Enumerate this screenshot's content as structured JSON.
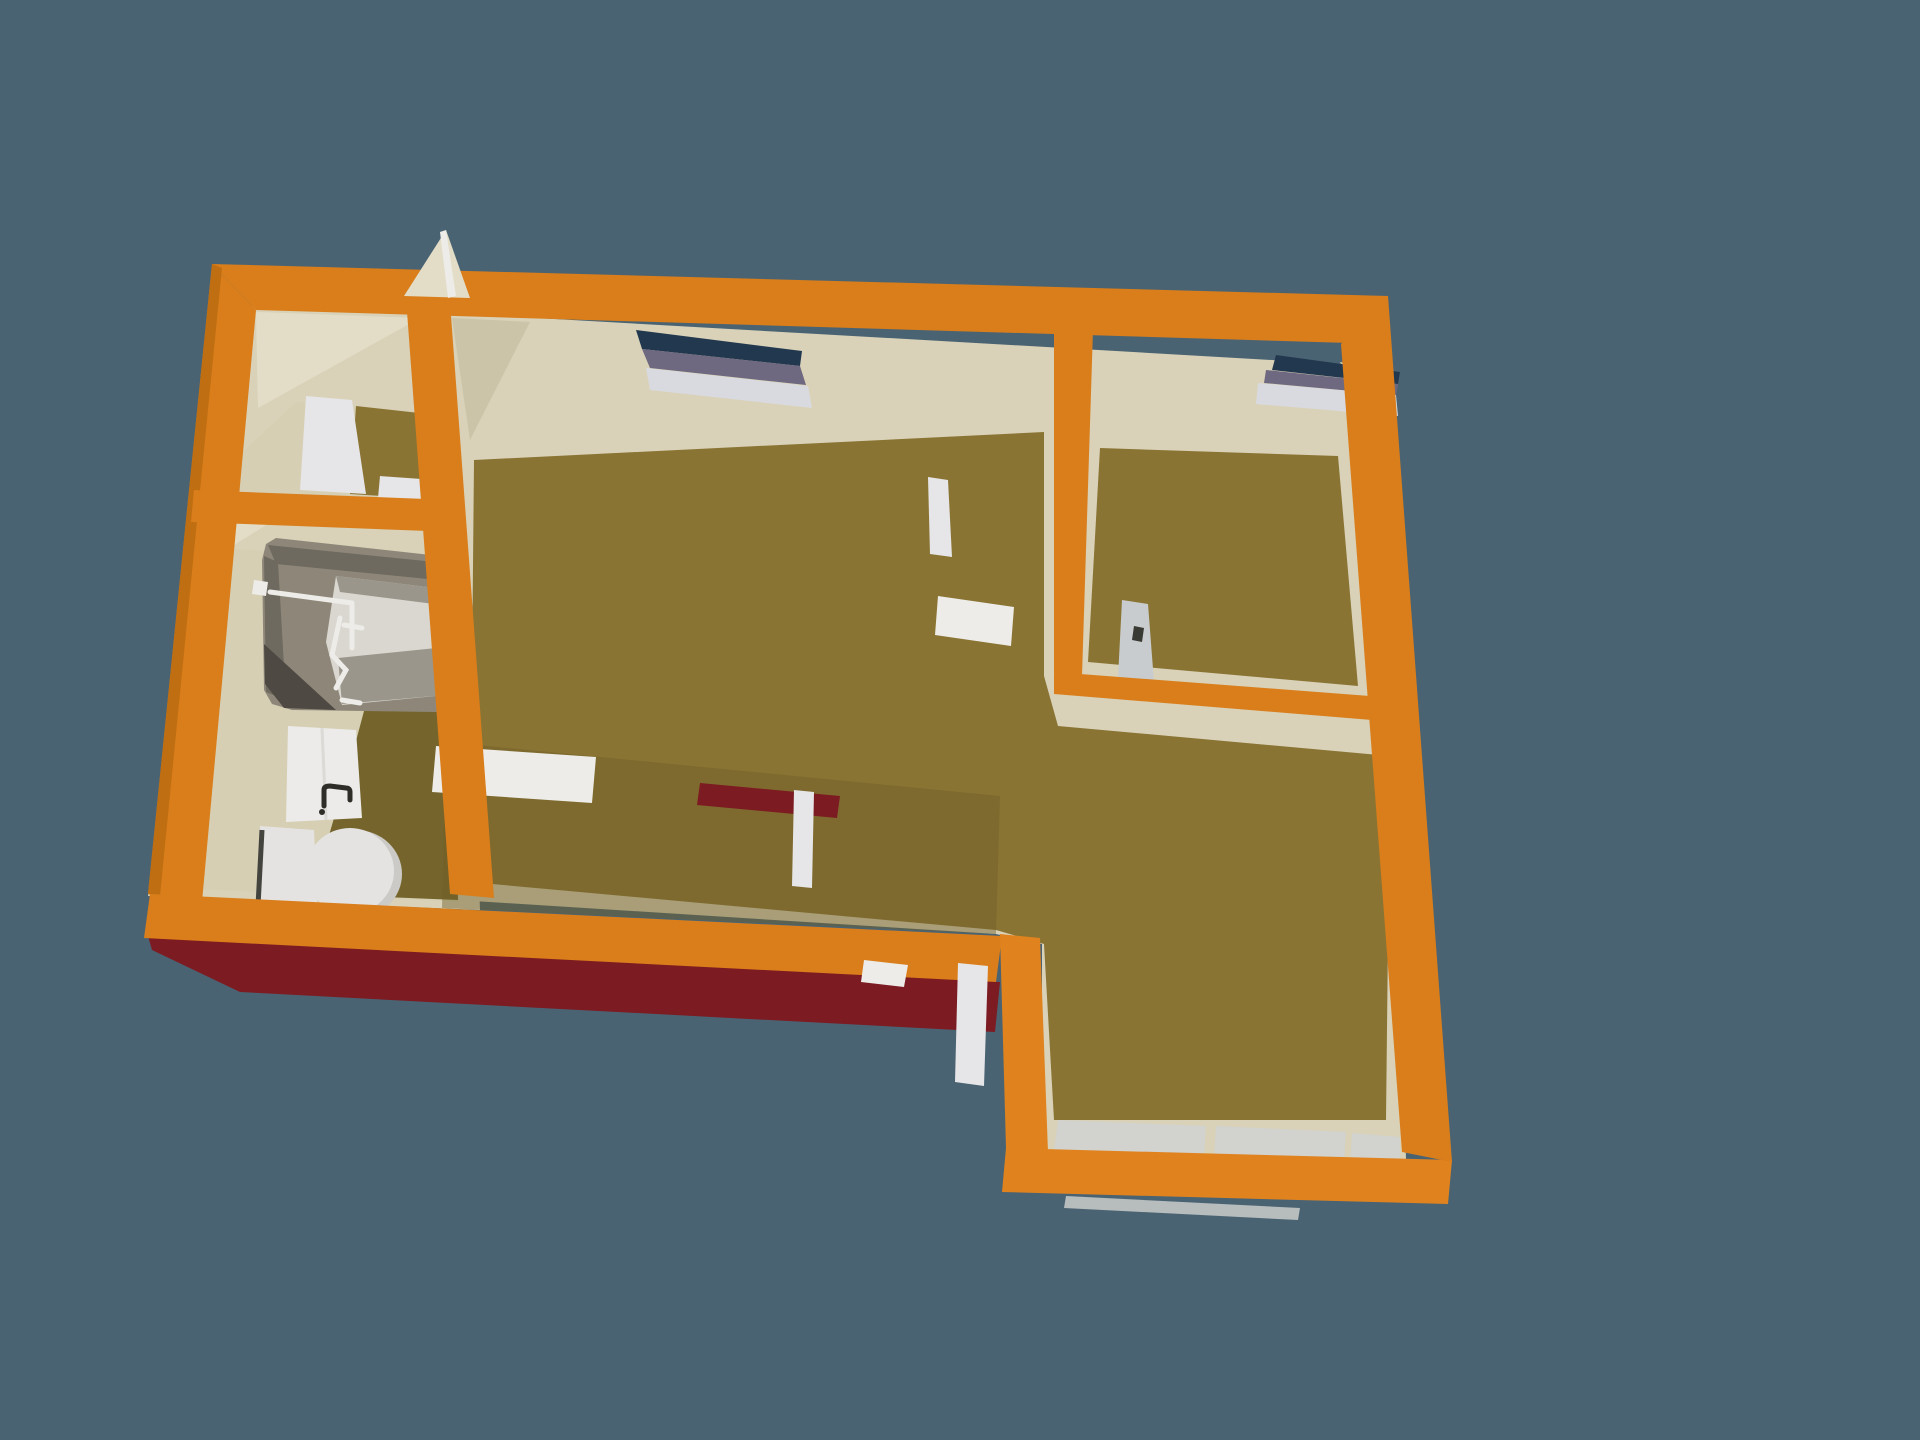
{
  "scene": {
    "description": "Aerial 3D perspective render of an L-shaped apartment floor plan floating on a slate-blue background",
    "rooms": [
      {
        "id": "entry-closet",
        "label": "entry closet"
      },
      {
        "id": "bathroom",
        "label": "bathroom"
      },
      {
        "id": "living-room",
        "label": "living room"
      },
      {
        "id": "bedroom",
        "label": "bedroom"
      },
      {
        "id": "dining-area",
        "label": "dining area"
      }
    ],
    "fixtures": [
      "bathtub",
      "shower-mixer",
      "washbasin",
      "toilet",
      "interior-door-leaves",
      "exterior-door-open",
      "window-living",
      "window-bedroom",
      "baseboards"
    ]
  },
  "colors": {
    "background": "#4A6373",
    "wall_top": "#D97E1B",
    "wall_top_dark": "#C06E12",
    "wall_top_bright": "#E0831F",
    "wall_face": "#D9D2B8",
    "wall_face_light": "#E3DDC7",
    "wall_face_shade": "#CBC4A8",
    "wall_exterior": "#7D1B22",
    "floor_main": "#8A7434",
    "floor_dark": "#75652C",
    "floor_bath": "#D6CFB4",
    "floor_shade": "#6F5F28",
    "window_glass_dark": "#22384E",
    "window_glass_purple": "#6E6880",
    "window_sill": "#D9DAE0",
    "fixture_white": "#EDECE8",
    "door_white": "#E6E5E7",
    "baseboard": "#D2D2CE",
    "jamb_gray": "#C9CCCE",
    "jamb_notch": "#3A3A34",
    "tub_body": "#8E8779",
    "tub_shadow": "#6E6A60",
    "tub_dark": "#4E4A43",
    "tub_inner": "#D9D7CF",
    "tub_band": "#9B968C",
    "toilet_white": "#E4E3E1",
    "basin_white": "#ECEBE9",
    "faucet_dark": "#2E2D28",
    "pipe_dark": "#44443E"
  }
}
